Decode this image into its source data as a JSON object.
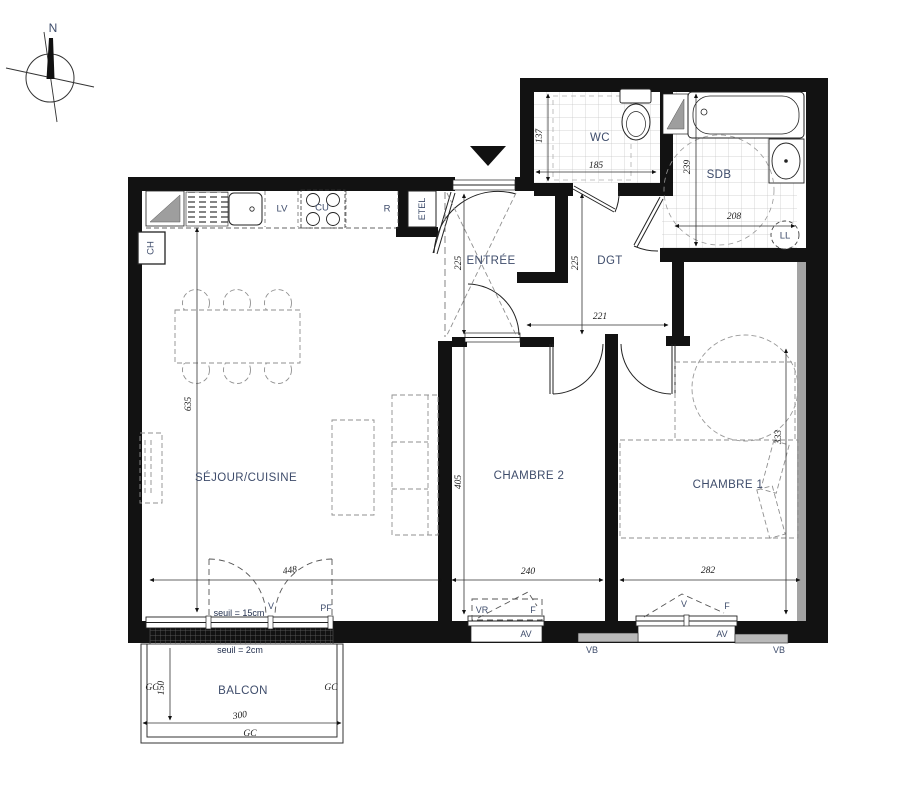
{
  "compass": {
    "north_label": "N"
  },
  "rooms": {
    "sejour": "SÉJOUR/CUISINE",
    "entree": "ENTRÉE",
    "dgt": "DGT",
    "wc": "WC",
    "sdb": "SDB",
    "chambre1": "CHAMBRE 1",
    "chambre2": "CHAMBRE 2",
    "balcon": "BALCON"
  },
  "kitchen": {
    "lv": "LV",
    "cu": "CU",
    "r": "R",
    "ch": "CH",
    "etel": "ETEL"
  },
  "appliances": {
    "ll": "LL"
  },
  "dimensions": {
    "sejour_height": "635",
    "sejour_width": "448",
    "entree_height": "225",
    "dgt_height": "225",
    "dgt_width": "221",
    "wc_height": "137",
    "wc_width": "185",
    "sdb_height": "239",
    "sdb_width": "208",
    "chambre2_height": "405",
    "chambre2_width": "240",
    "chambre1_height": "333",
    "chambre1_width": "282",
    "balcon_height": "150",
    "balcon_width": "300"
  },
  "thresholds": {
    "seuil_pf": "seuil = 15cm",
    "seuil_balcon": "seuil = 2cm"
  },
  "openings": {
    "pf_label": "PF",
    "v_sejour": "V",
    "vr_chambre2": "VR",
    "f_chambre2": "F",
    "av_chambre2": "AV",
    "vb_chambre2": "VB",
    "v_chambre1": "V",
    "f_chambre1": "F",
    "av_chambre1": "AV",
    "vb_chambre1": "VB"
  },
  "balcony": {
    "gc_left": "GC",
    "gc_right": "GC",
    "gc_bottom": "GC"
  },
  "colors": {
    "wall": "#121212",
    "room_label": "#3e4c6b",
    "dimension_text": "#1c1c1c",
    "fixture_gray": "#9e9e9e",
    "tile_line": "#c6c6c6"
  }
}
